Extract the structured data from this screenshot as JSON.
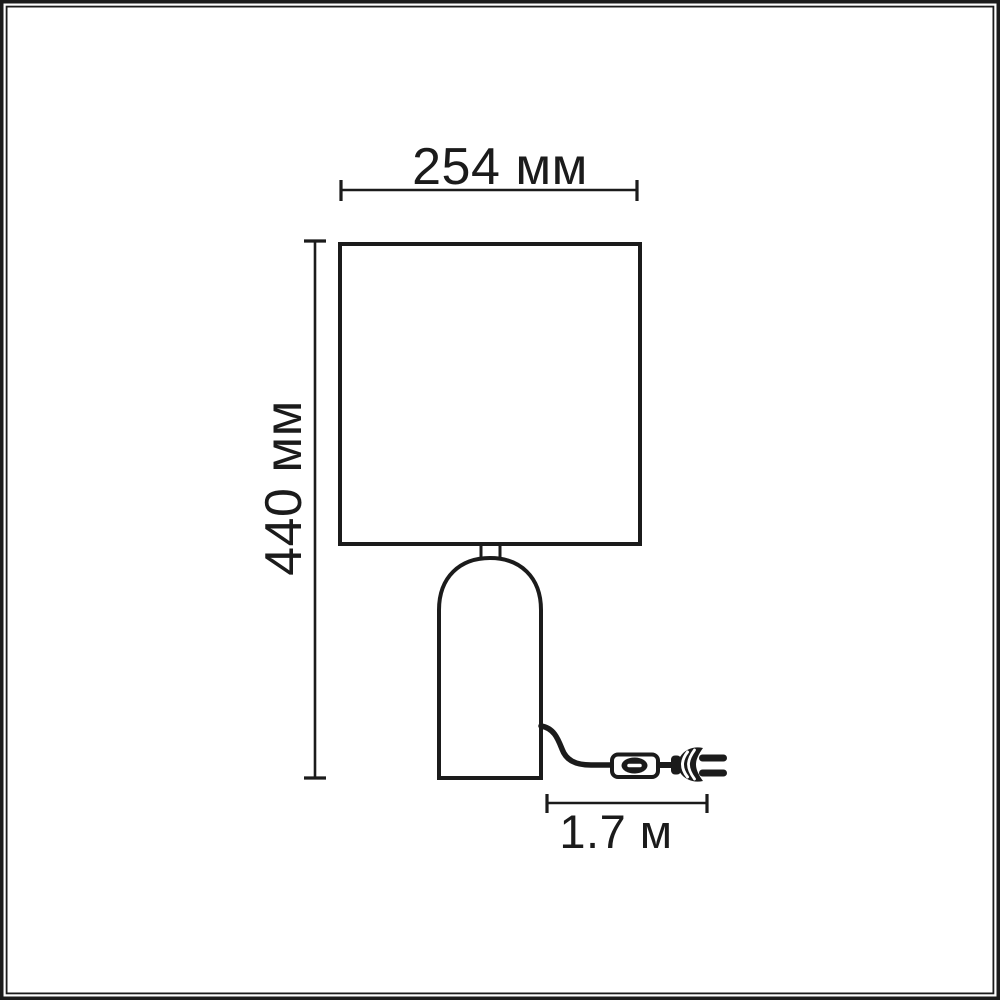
{
  "colors": {
    "line": "#1b1b1b",
    "background": "#ffffff"
  },
  "diagram": {
    "subject": "table-lamp-dimension-drawing",
    "width_dim": {
      "label": "254 мм"
    },
    "height_dim": {
      "label": "440 мм"
    },
    "cable_dim": {
      "label": "1.7 м"
    }
  }
}
